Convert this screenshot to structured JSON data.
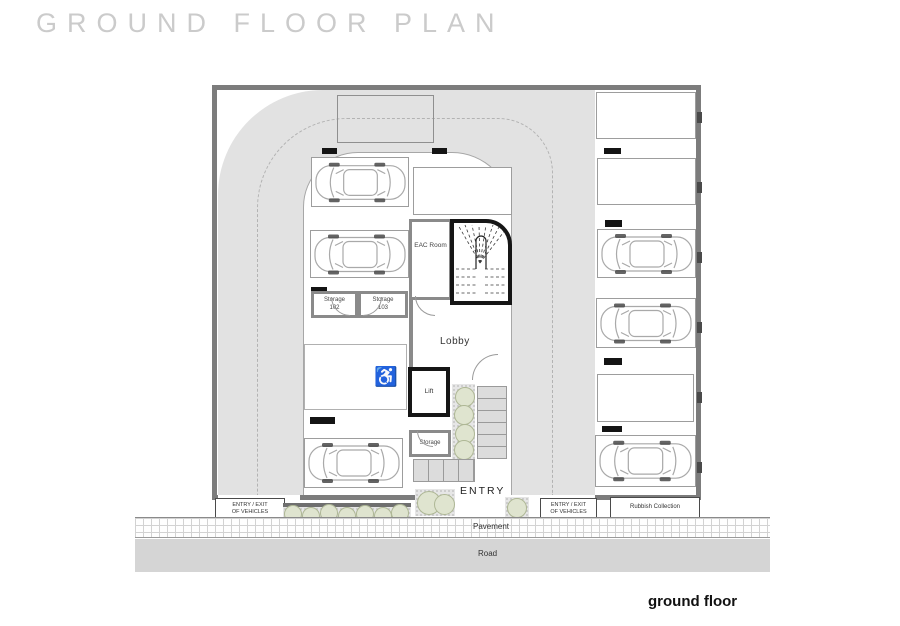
{
  "page": {
    "title": "GROUND FLOOR PLAN",
    "caption": "ground floor"
  },
  "plan": {
    "eac_room": "EAC Room",
    "storage_102": {
      "line1": "Storage",
      "line2": "102"
    },
    "storage_103": {
      "line1": "Storage",
      "line2": "103"
    },
    "lobby": "Lobby",
    "lift": "Lift",
    "storage": "Storage",
    "entry": "ENTRY",
    "accessible_icon": "♿"
  },
  "site": {
    "entry_exit": {
      "line1": "ENTRY / EXIT",
      "line2": "OF VEHICLES"
    },
    "rubbish_collection": "Rubbish Collection",
    "pavement": "Pavement",
    "road": "Road"
  },
  "colors": {
    "driveway": "#e2e2e2",
    "outer_wall": "#7c7c7c",
    "stair_wall": "#161616",
    "road": "#d5d5d5",
    "bush_fill": "#dfe4cf",
    "bush_stroke": "#aeb795",
    "title": "#cbcbcb"
  }
}
